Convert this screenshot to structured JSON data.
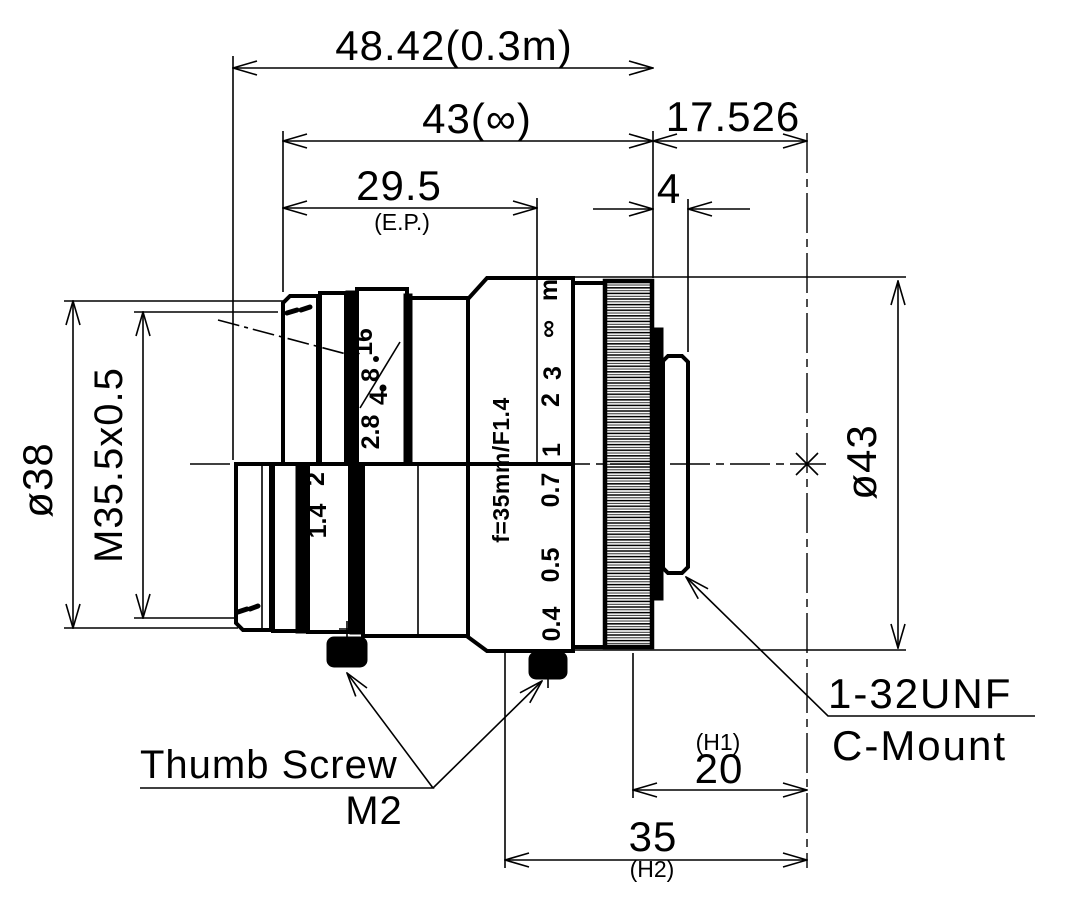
{
  "dimensions": {
    "overall_at_03m": "48.42(0.3m)",
    "overall_at_inf": "43(∞)",
    "flange_back": "17.526",
    "entrance_pupil": "29.5",
    "entrance_pupil_note": "(E.P.)",
    "mount_flange_width": "4",
    "front_diameter": "ø38",
    "filter_thread": "M35.5x0.5",
    "body_diameter": "ø43",
    "h1_note": "(H1)",
    "h1_value": "20",
    "h2_value": "35",
    "h2_note": "(H2)"
  },
  "labels": {
    "mount_thread": "1-32UNF",
    "mount_type": "C-Mount",
    "screw_label": "Thumb Screw",
    "screw_size": "M2"
  },
  "barrel": {
    "model_marking": "f=35mm/F1.4",
    "aperture_scale": [
      "1.4",
      "2",
      "2.8",
      "4",
      "8",
      "16"
    ],
    "focus_scale": [
      "0.4",
      "0.5",
      "0.7",
      "1",
      "2",
      "3",
      "∞"
    ],
    "focus_unit": "m"
  }
}
